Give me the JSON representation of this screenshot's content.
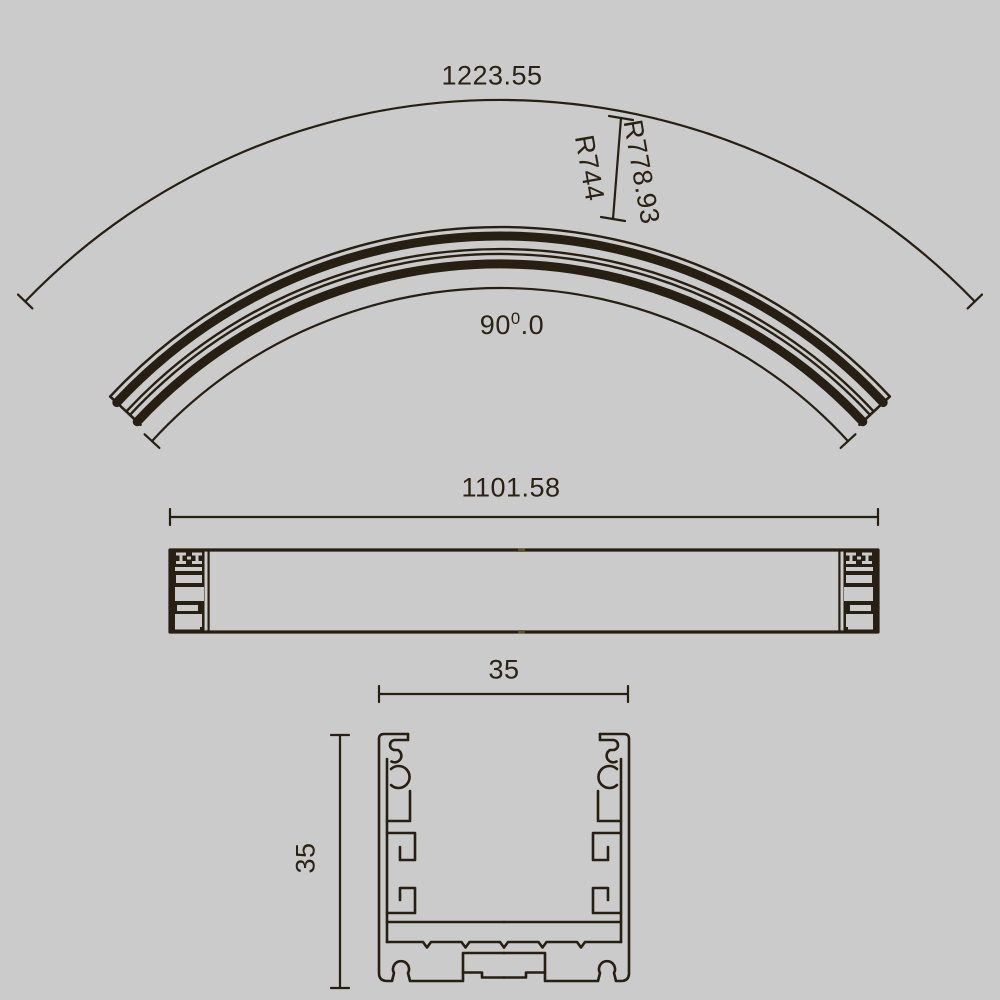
{
  "drawing": {
    "background_color": "#cbcbcb",
    "ink_color": "#271f12",
    "curved_view": {
      "outer_arc_length_label": "1223.55",
      "radius_outer_label": "R778.93",
      "radius_inner_label": "R744",
      "angle_main": "90",
      "angle_sup": "0",
      "angle_decimal": ".0"
    },
    "side_view": {
      "length_label": "1101.58"
    },
    "section_view": {
      "width_label": "35",
      "height_label": "35"
    }
  }
}
